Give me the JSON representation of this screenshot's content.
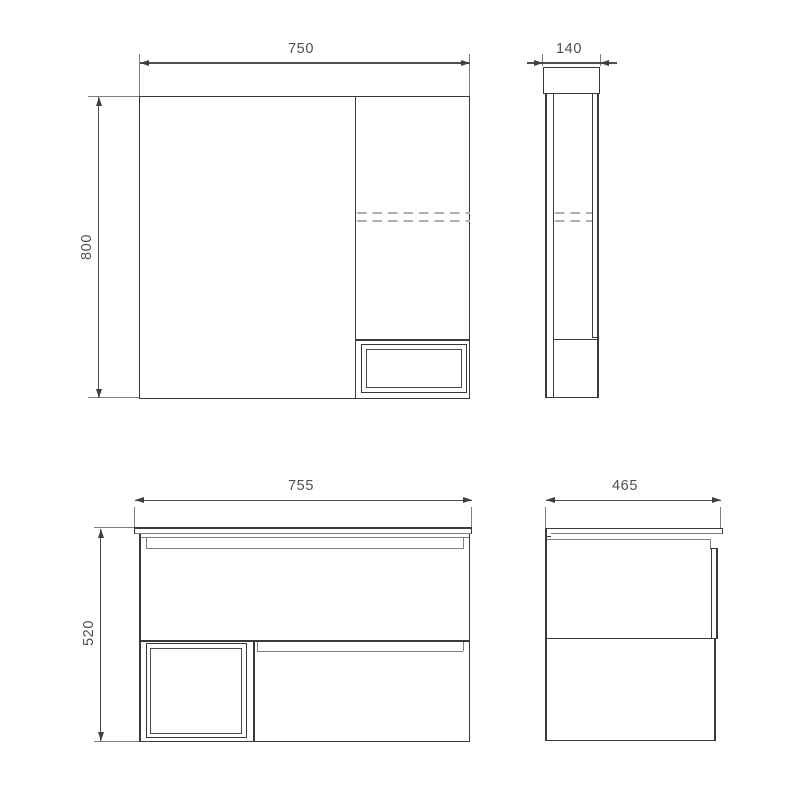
{
  "drawing": {
    "dims": {
      "mirror_front_width": "750",
      "mirror_front_height": "800",
      "mirror_side_depth": "140",
      "vanity_front_width": "755",
      "vanity_front_height": "520",
      "vanity_side_depth": "465"
    },
    "colors": {
      "outline_dark": "#3a3a3a",
      "line_gray": "#7f7f7f",
      "dashed_light": "#aeaeae",
      "dimension": "#4f4f4f",
      "background": "#ffffff"
    }
  }
}
